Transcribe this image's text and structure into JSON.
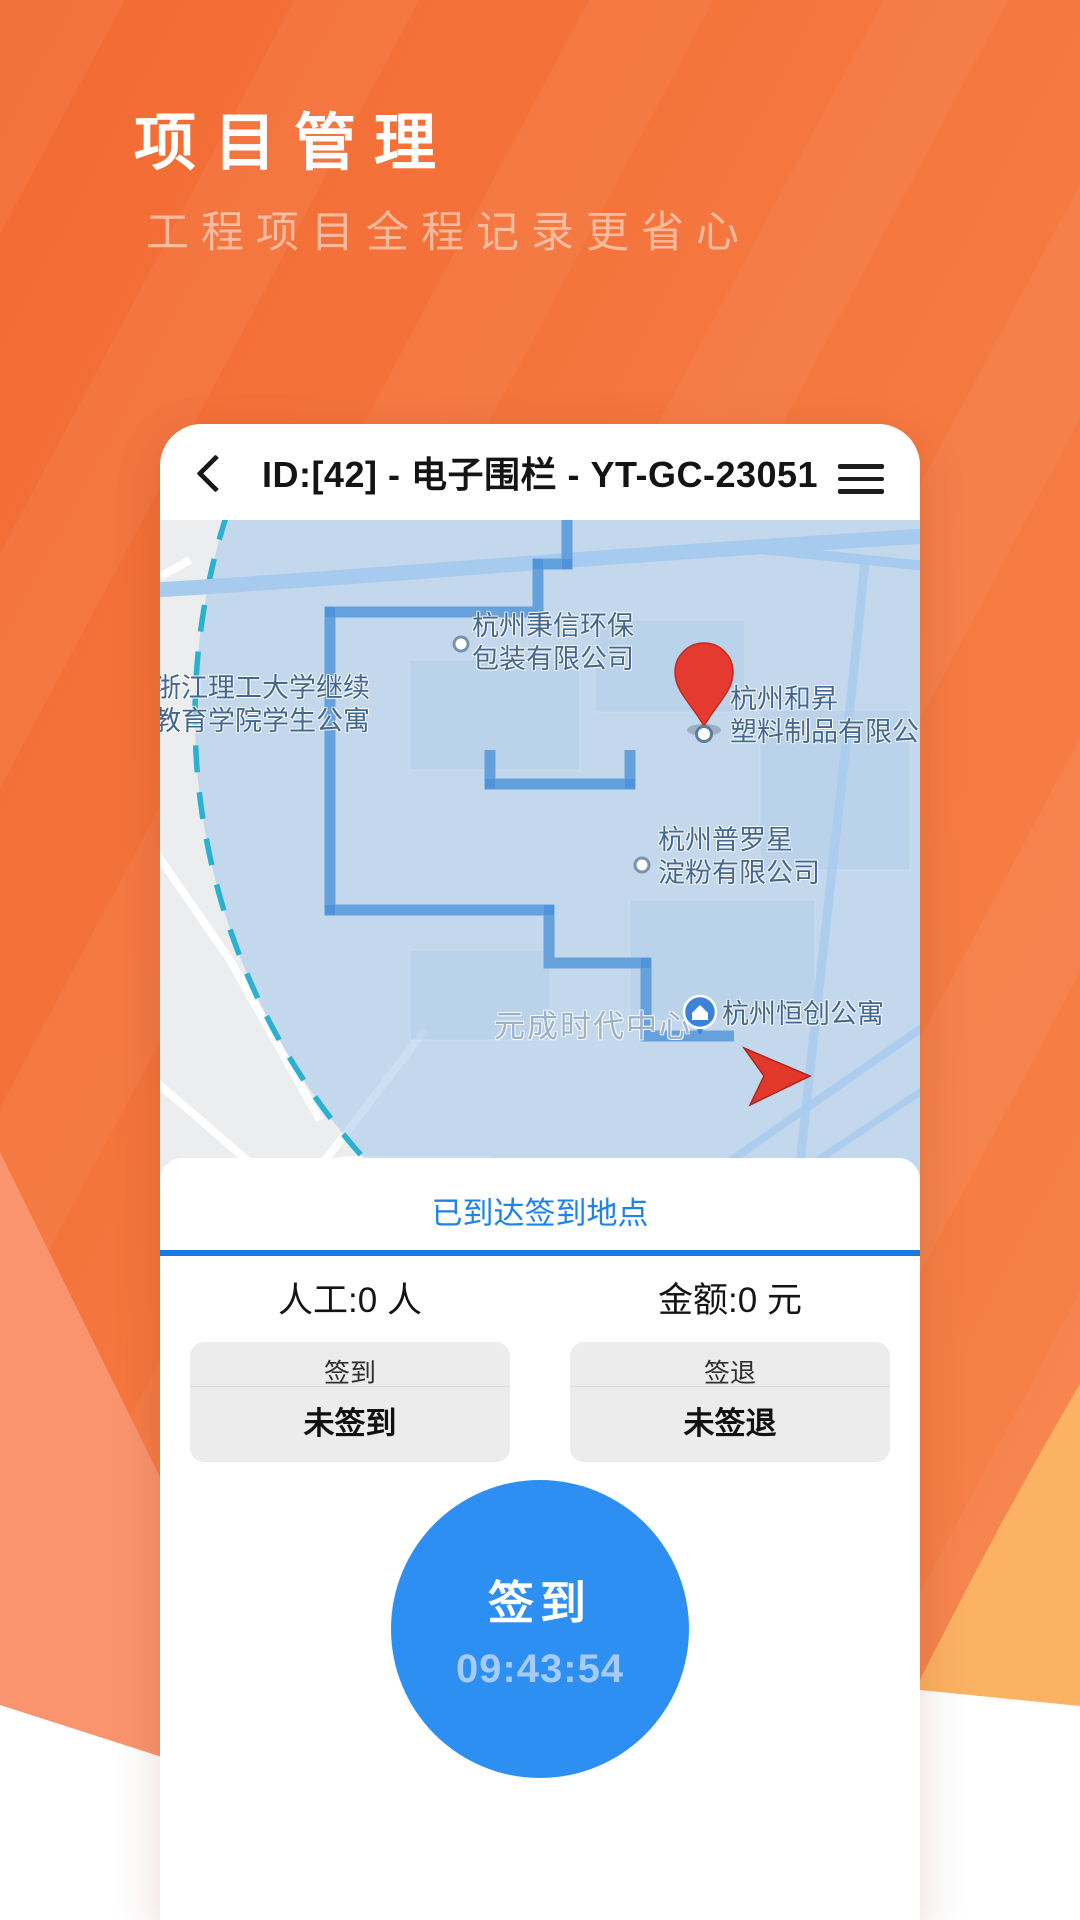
{
  "hero": {
    "title": "项目管理",
    "subtitle": "工程项目全程记录更省心"
  },
  "app": {
    "header": {
      "title": "ID:[42] - 电子围栏 - YT-GC-23051"
    },
    "map": {
      "labels": {
        "campus": {
          "line1": "浙江理工大学继续",
          "line2": "教育学院学生公寓"
        },
        "bingxin": {
          "line1": "杭州秉信环保",
          "line2": "包装有限公司"
        },
        "hesheng": {
          "line1": "杭州和昇",
          "line2": "塑料制品有限公"
        },
        "puluoxing": {
          "line1": "杭州普罗星",
          "line2": "淀粉有限公司"
        },
        "yuancheng": {
          "line1": "元成时代中心"
        },
        "hengchuang": {
          "line1": "杭州恒创公寓"
        }
      }
    },
    "panel": {
      "status": "已到达签到地点",
      "stats": {
        "labor": "人工:0 人",
        "amount": "金额:0 元"
      },
      "checkin_card": {
        "title": "签到",
        "value": "未签到"
      },
      "checkout_card": {
        "title": "签退",
        "value": "未签退"
      },
      "action_button": {
        "label": "签到",
        "time": "09:43:54"
      }
    }
  },
  "colors": {
    "accent_orange": "#f5773f",
    "accent_salmon": "#f9946f",
    "accent_amber": "#fbb263",
    "action_blue": "#2e8ff2",
    "status_blue": "#1e82ea",
    "divider_blue": "#1b78e0",
    "fence_teal": "#2ab1d2",
    "route_blue": "#5f9edc",
    "pin_red": "#e2382c"
  }
}
